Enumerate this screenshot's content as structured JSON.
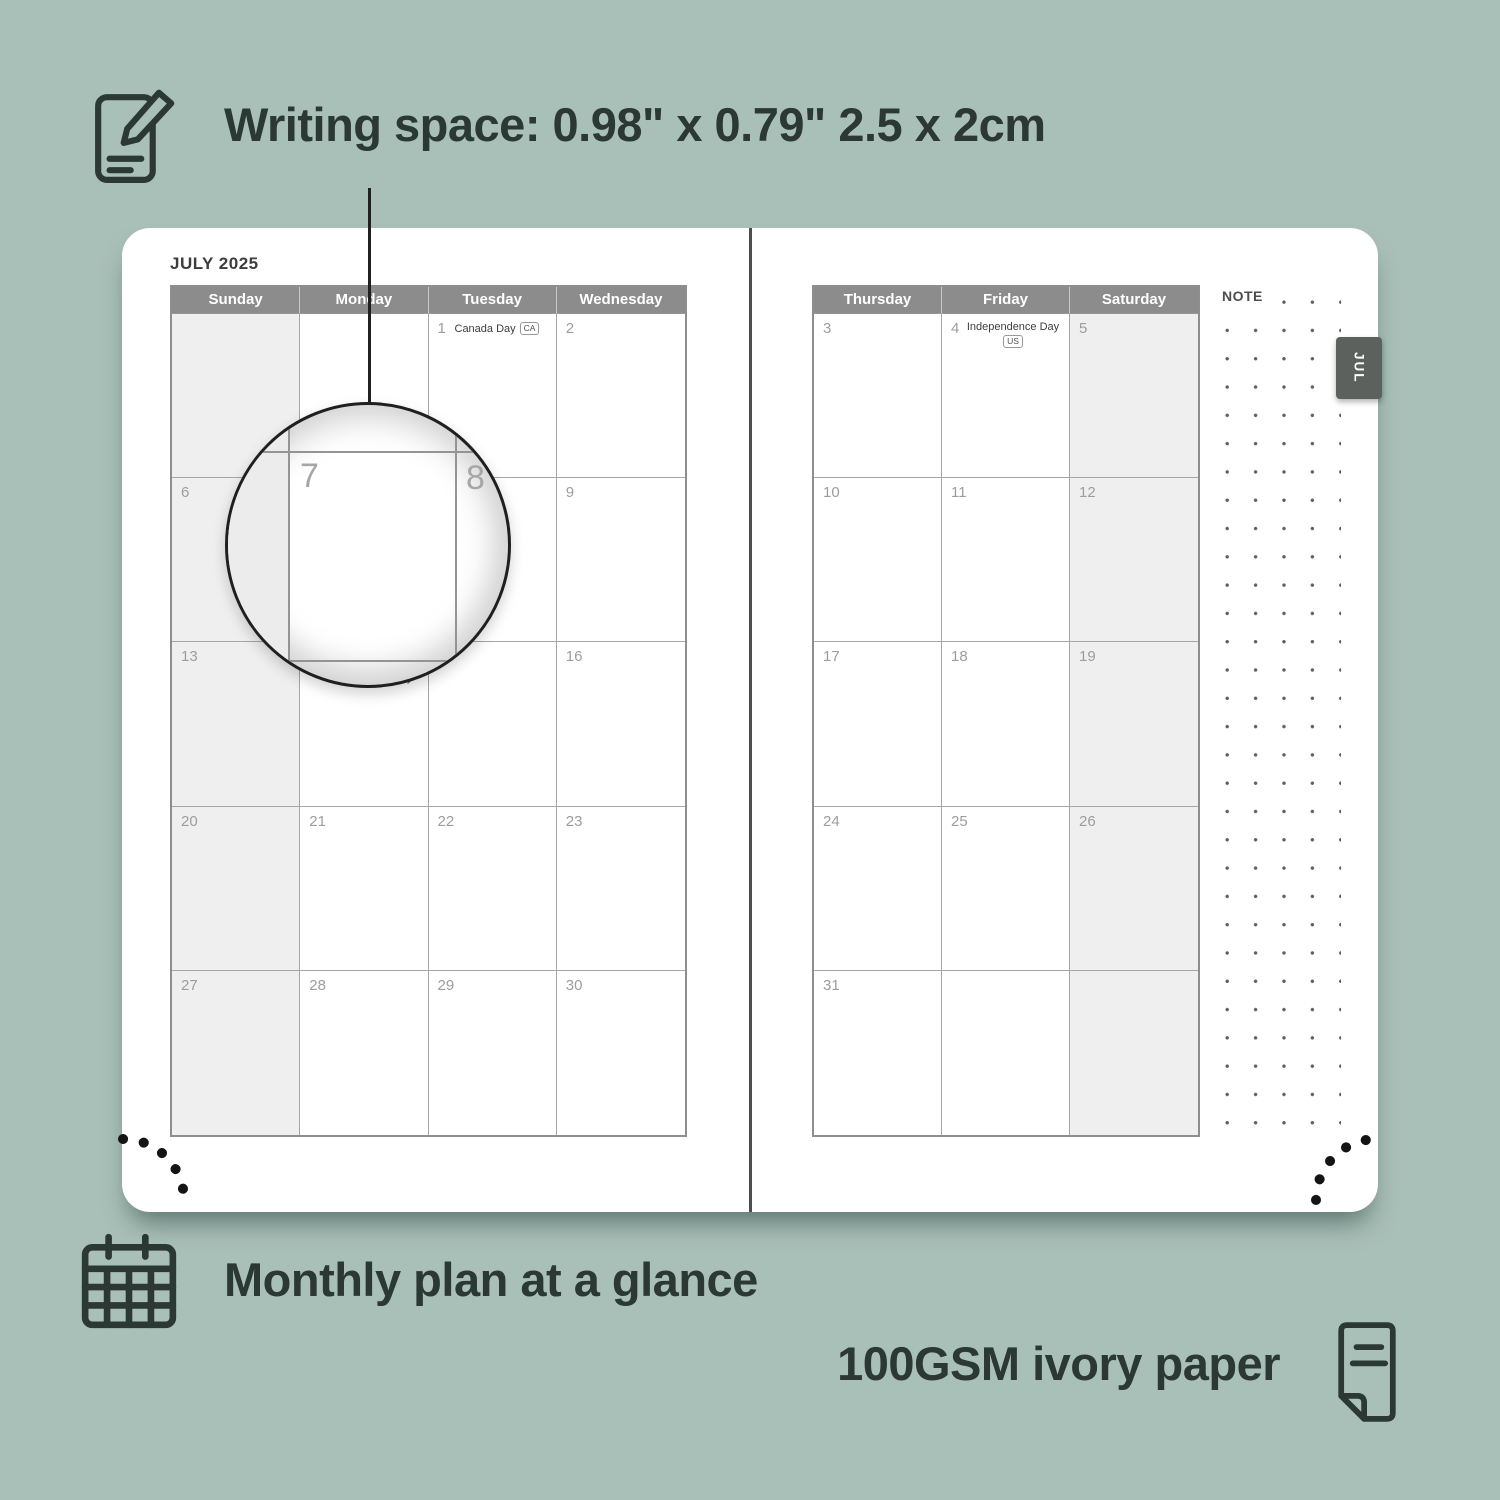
{
  "top_caption": {
    "text": "Writing space: 0.98\" x 0.79\" 2.5 x 2cm",
    "icon": "note-pencil-icon"
  },
  "bottom_captions": {
    "monthly": "Monthly plan at a glance",
    "paper": "100GSM ivory paper"
  },
  "planner": {
    "month_title": "JULY 2025",
    "tab_label": "JUL",
    "note_label": "NOTE",
    "left_headers": [
      "Sunday",
      "Monday",
      "Tuesday",
      "Wednesday"
    ],
    "right_headers": [
      "Thursday",
      "Friday",
      "Saturday"
    ],
    "left_rows": [
      [
        {
          "day": ""
        },
        {
          "day": ""
        },
        {
          "day": "1",
          "holiday": "Canada Day",
          "badge": "CA"
        },
        {
          "day": "2"
        }
      ],
      [
        {
          "day": "6"
        },
        {
          "day": "7"
        },
        {
          "day": "8"
        },
        {
          "day": "9"
        }
      ],
      [
        {
          "day": "13"
        },
        {
          "day": "14",
          "holiday": "Orangemen's Day",
          "badge": ""
        },
        {
          "day": "15"
        },
        {
          "day": "16"
        }
      ],
      [
        {
          "day": "20"
        },
        {
          "day": "21"
        },
        {
          "day": "22"
        },
        {
          "day": "23"
        }
      ],
      [
        {
          "day": "27"
        },
        {
          "day": "28"
        },
        {
          "day": "29"
        },
        {
          "day": "30"
        }
      ]
    ],
    "right_rows": [
      [
        {
          "day": "3"
        },
        {
          "day": "4",
          "holiday": "Independence Day",
          "badge": "US"
        },
        {
          "day": "5"
        }
      ],
      [
        {
          "day": "10"
        },
        {
          "day": "11"
        },
        {
          "day": "12"
        }
      ],
      [
        {
          "day": "17"
        },
        {
          "day": "18"
        },
        {
          "day": "19"
        }
      ],
      [
        {
          "day": "24"
        },
        {
          "day": "25"
        },
        {
          "day": "26"
        }
      ],
      [
        {
          "day": "31"
        },
        {
          "day": ""
        },
        {
          "day": ""
        }
      ]
    ],
    "magnifier": {
      "left_day": "7",
      "right_day": "8"
    }
  },
  "colors": {
    "background": "#a9c0b9",
    "ink": "#2b3834",
    "header_bg": "#8c8c8c",
    "header_text": "#ffffff",
    "shaded_cell": "#efefef",
    "day_number": "#9d9d9d",
    "tab_bg": "#5d615e",
    "grid_line": "#a6a6a6"
  }
}
